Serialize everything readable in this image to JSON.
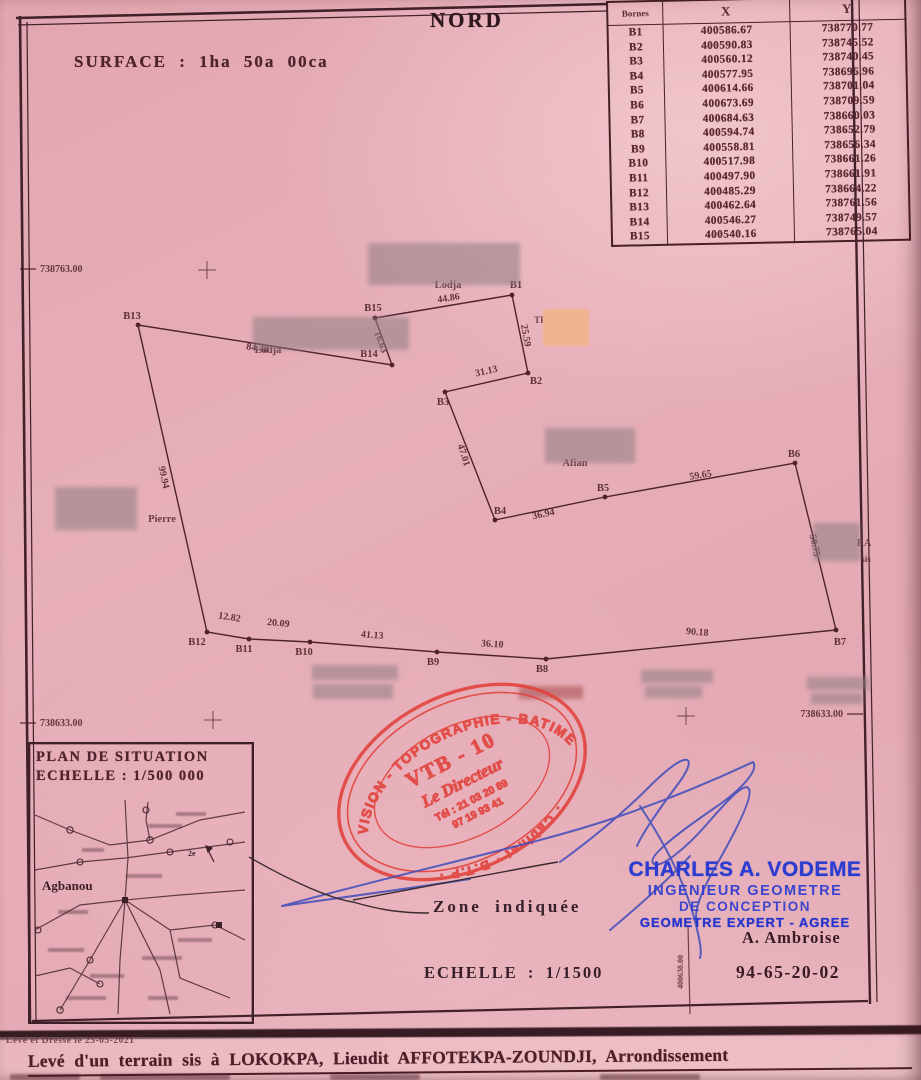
{
  "page": {
    "north_label": "NORD",
    "surface_text": "SURFACE : 1ha 50a 00ca"
  },
  "bornes_table": {
    "headers": [
      "Bornes",
      "X",
      "Y"
    ],
    "rows": [
      [
        "B1",
        "400586.67",
        "738770.77"
      ],
      [
        "B2",
        "400590.83",
        "738745.52"
      ],
      [
        "B3",
        "400560.12",
        "738740.45"
      ],
      [
        "B4",
        "400577.95",
        "738696.96"
      ],
      [
        "B5",
        "400614.66",
        "738701.04"
      ],
      [
        "B6",
        "400673.69",
        "738709.59"
      ],
      [
        "B7",
        "400684.63",
        "738660.03"
      ],
      [
        "B8",
        "400594.74",
        "738652.79"
      ],
      [
        "B9",
        "400558.81",
        "738656.34"
      ],
      [
        "B10",
        "400517.98",
        "738661.26"
      ],
      [
        "B11",
        "400497.90",
        "738661.91"
      ],
      [
        "B12",
        "400485.29",
        "738664.22"
      ],
      [
        "B13",
        "400462.64",
        "738761.56"
      ],
      [
        "B14",
        "400546.27",
        "738749.57"
      ],
      [
        "B15",
        "400540.16",
        "738765.04"
      ]
    ]
  },
  "grid": {
    "left_labels": [
      {
        "text": "738763.00",
        "x": 40,
        "y": 272
      },
      {
        "text": "738633.00",
        "x": 40,
        "y": 726
      }
    ],
    "right_label": {
      "text": "738633.00",
      "x": 843,
      "y": 717
    },
    "vertical_label": {
      "text": "400638.00",
      "x": 683,
      "y": 972
    },
    "crosses": [
      {
        "x": 207,
        "y": 270
      },
      {
        "x": 213,
        "y": 720
      },
      {
        "x": 686,
        "y": 716
      }
    ]
  },
  "parcel": {
    "points": [
      {
        "name": "B1",
        "x": 512,
        "y": 295,
        "lx": 516,
        "ly": 288
      },
      {
        "name": "B2",
        "x": 528,
        "y": 373,
        "lx": 536,
        "ly": 384
      },
      {
        "name": "B3",
        "x": 445,
        "y": 392,
        "lx": 443,
        "ly": 405
      },
      {
        "name": "B4",
        "x": 495,
        "y": 520,
        "lx": 500,
        "ly": 514
      },
      {
        "name": "B5",
        "x": 605,
        "y": 497,
        "lx": 603,
        "ly": 491
      },
      {
        "name": "B6",
        "x": 795,
        "y": 463,
        "lx": 794,
        "ly": 457
      },
      {
        "name": "B7",
        "x": 836,
        "y": 630,
        "lx": 840,
        "ly": 645
      },
      {
        "name": "B8",
        "x": 546,
        "y": 659,
        "lx": 542,
        "ly": 672
      },
      {
        "name": "B9",
        "x": 437,
        "y": 652,
        "lx": 433,
        "ly": 665
      },
      {
        "name": "B10",
        "x": 310,
        "y": 642,
        "lx": 304,
        "ly": 655
      },
      {
        "name": "B11",
        "x": 249,
        "y": 639,
        "lx": 244,
        "ly": 652
      },
      {
        "name": "B12",
        "x": 207,
        "y": 632,
        "lx": 197,
        "ly": 645
      },
      {
        "name": "B13",
        "x": 138,
        "y": 325,
        "lx": 132,
        "ly": 319
      },
      {
        "name": "B14",
        "x": 392,
        "y": 365,
        "lx": 369,
        "ly": 357
      },
      {
        "name": "B15",
        "x": 375,
        "y": 318,
        "lx": 373,
        "ly": 311
      }
    ],
    "segments": [
      {
        "label": "44.86",
        "tx": 449,
        "ty": 301,
        "rot": -9
      },
      {
        "label": "25.59",
        "tx": 523,
        "ty": 336,
        "rot": 80
      },
      {
        "label": "31.13",
        "tx": 487,
        "ty": 374,
        "rot": -13
      },
      {
        "label": "47.01",
        "tx": 461,
        "ty": 456,
        "rot": 72
      },
      {
        "label": "36.94",
        "tx": 544,
        "ty": 517,
        "rot": -12
      },
      {
        "label": "59.65",
        "tx": 701,
        "ty": 478,
        "rot": -9
      },
      {
        "label": "50.75",
        "tx": 812,
        "ty": 546,
        "rot": 78
      },
      {
        "label": "90.18",
        "tx": 697,
        "ty": 635,
        "rot": 5
      },
      {
        "label": "36.10",
        "tx": 492,
        "ty": 647,
        "rot": 4
      },
      {
        "label": "41.13",
        "tx": 372,
        "ty": 638,
        "rot": 5
      },
      {
        "label": "20.09",
        "tx": 278,
        "ty": 626,
        "rot": 6
      },
      {
        "label": "12.82",
        "tx": 229,
        "ty": 620,
        "rot": 9
      },
      {
        "label": "99.94",
        "tx": 161,
        "ty": 478,
        "rot": 77
      },
      {
        "label": "84.48",
        "tx": 257,
        "ty": 351,
        "rot": 9
      },
      {
        "label": "16.63",
        "tx": 378,
        "ty": 343,
        "rot": 70
      }
    ],
    "place_labels": [
      {
        "text": "Lodja",
        "x": 448,
        "y": 288,
        "size": 10.5
      },
      {
        "text": "Lodja",
        "x": 268,
        "y": 353,
        "size": 10.5
      },
      {
        "text": "Afian",
        "x": 575,
        "y": 466,
        "size": 10.5
      },
      {
        "text": "Pierre",
        "x": 162,
        "y": 522,
        "size": 10.5
      },
      {
        "text": "TF",
        "x": 540,
        "y": 323,
        "size": 9
      },
      {
        "text": "RA",
        "x": 864,
        "y": 546,
        "size": 10
      },
      {
        "text": "sis",
        "x": 866,
        "y": 562,
        "size": 9
      }
    ]
  },
  "situation": {
    "title_line1": "PLAN DE SITUATION",
    "title_line2": "ECHELLE : 1/500 000",
    "town_label": "Agbanou",
    "north_mark": "2e"
  },
  "stamp": {
    "arc_top": "VISION - TOPOGRAPHIE - BATIMENT",
    "arc_bottom": "· Cabinet · B.T.P ·",
    "line1": "VTB - 10",
    "line2": "Le Directeur",
    "line3": "Tél : 21 03 20 89",
    "line4": "97 19 93 41"
  },
  "surveyor": {
    "name": "CHARLES A. VODEME",
    "title1": "INGENIEUR GEOMETRE",
    "title2": "DE CONCEPTION",
    "title3": "GEOMETRE EXPERT - AGREE",
    "contact_name": "A. Ambroise",
    "phone": "94-65-20-02"
  },
  "annotations": {
    "zone_label": "Zone indiquée",
    "scale_label": "ECHELLE : 1/1500"
  },
  "footer": {
    "survey_date_line": "Levé et Dressé   le 25-05-2021",
    "description_line": "Levé d'un terrain sis à LOKOKPA, Lieudit AFFOTEKPA-ZOUNDJI, Arrondissement"
  },
  "redactions": [
    {
      "x": 368,
      "y": 243,
      "w": 152,
      "h": 42,
      "tint": "grey"
    },
    {
      "x": 253,
      "y": 317,
      "w": 156,
      "h": 33,
      "tint": "grey"
    },
    {
      "x": 543,
      "y": 309,
      "w": 46,
      "h": 37,
      "tint": "orange"
    },
    {
      "x": 545,
      "y": 428,
      "w": 90,
      "h": 35,
      "tint": "grey"
    },
    {
      "x": 55,
      "y": 487,
      "w": 82,
      "h": 43,
      "tint": "grey"
    },
    {
      "x": 813,
      "y": 523,
      "w": 47,
      "h": 38,
      "tint": "grey"
    },
    {
      "x": 312,
      "y": 665,
      "w": 86,
      "h": 15,
      "tint": "grey"
    },
    {
      "x": 313,
      "y": 684,
      "w": 80,
      "h": 15,
      "tint": "grey"
    },
    {
      "x": 519,
      "y": 686,
      "w": 64,
      "h": 13,
      "tint": "red"
    },
    {
      "x": 641,
      "y": 670,
      "w": 72,
      "h": 13,
      "tint": "grey"
    },
    {
      "x": 645,
      "y": 686,
      "w": 57,
      "h": 12,
      "tint": "grey"
    },
    {
      "x": 807,
      "y": 677,
      "w": 62,
      "h": 13,
      "tint": "grey"
    },
    {
      "x": 811,
      "y": 693,
      "w": 52,
      "h": 11,
      "tint": "grey"
    }
  ],
  "colors": {
    "paper": "#e5abb5",
    "ink": "#4f232c",
    "stamp_red": "#e2423c",
    "stamp_blue": "#2c3bd0",
    "signature_blue": "#3f4cba"
  }
}
